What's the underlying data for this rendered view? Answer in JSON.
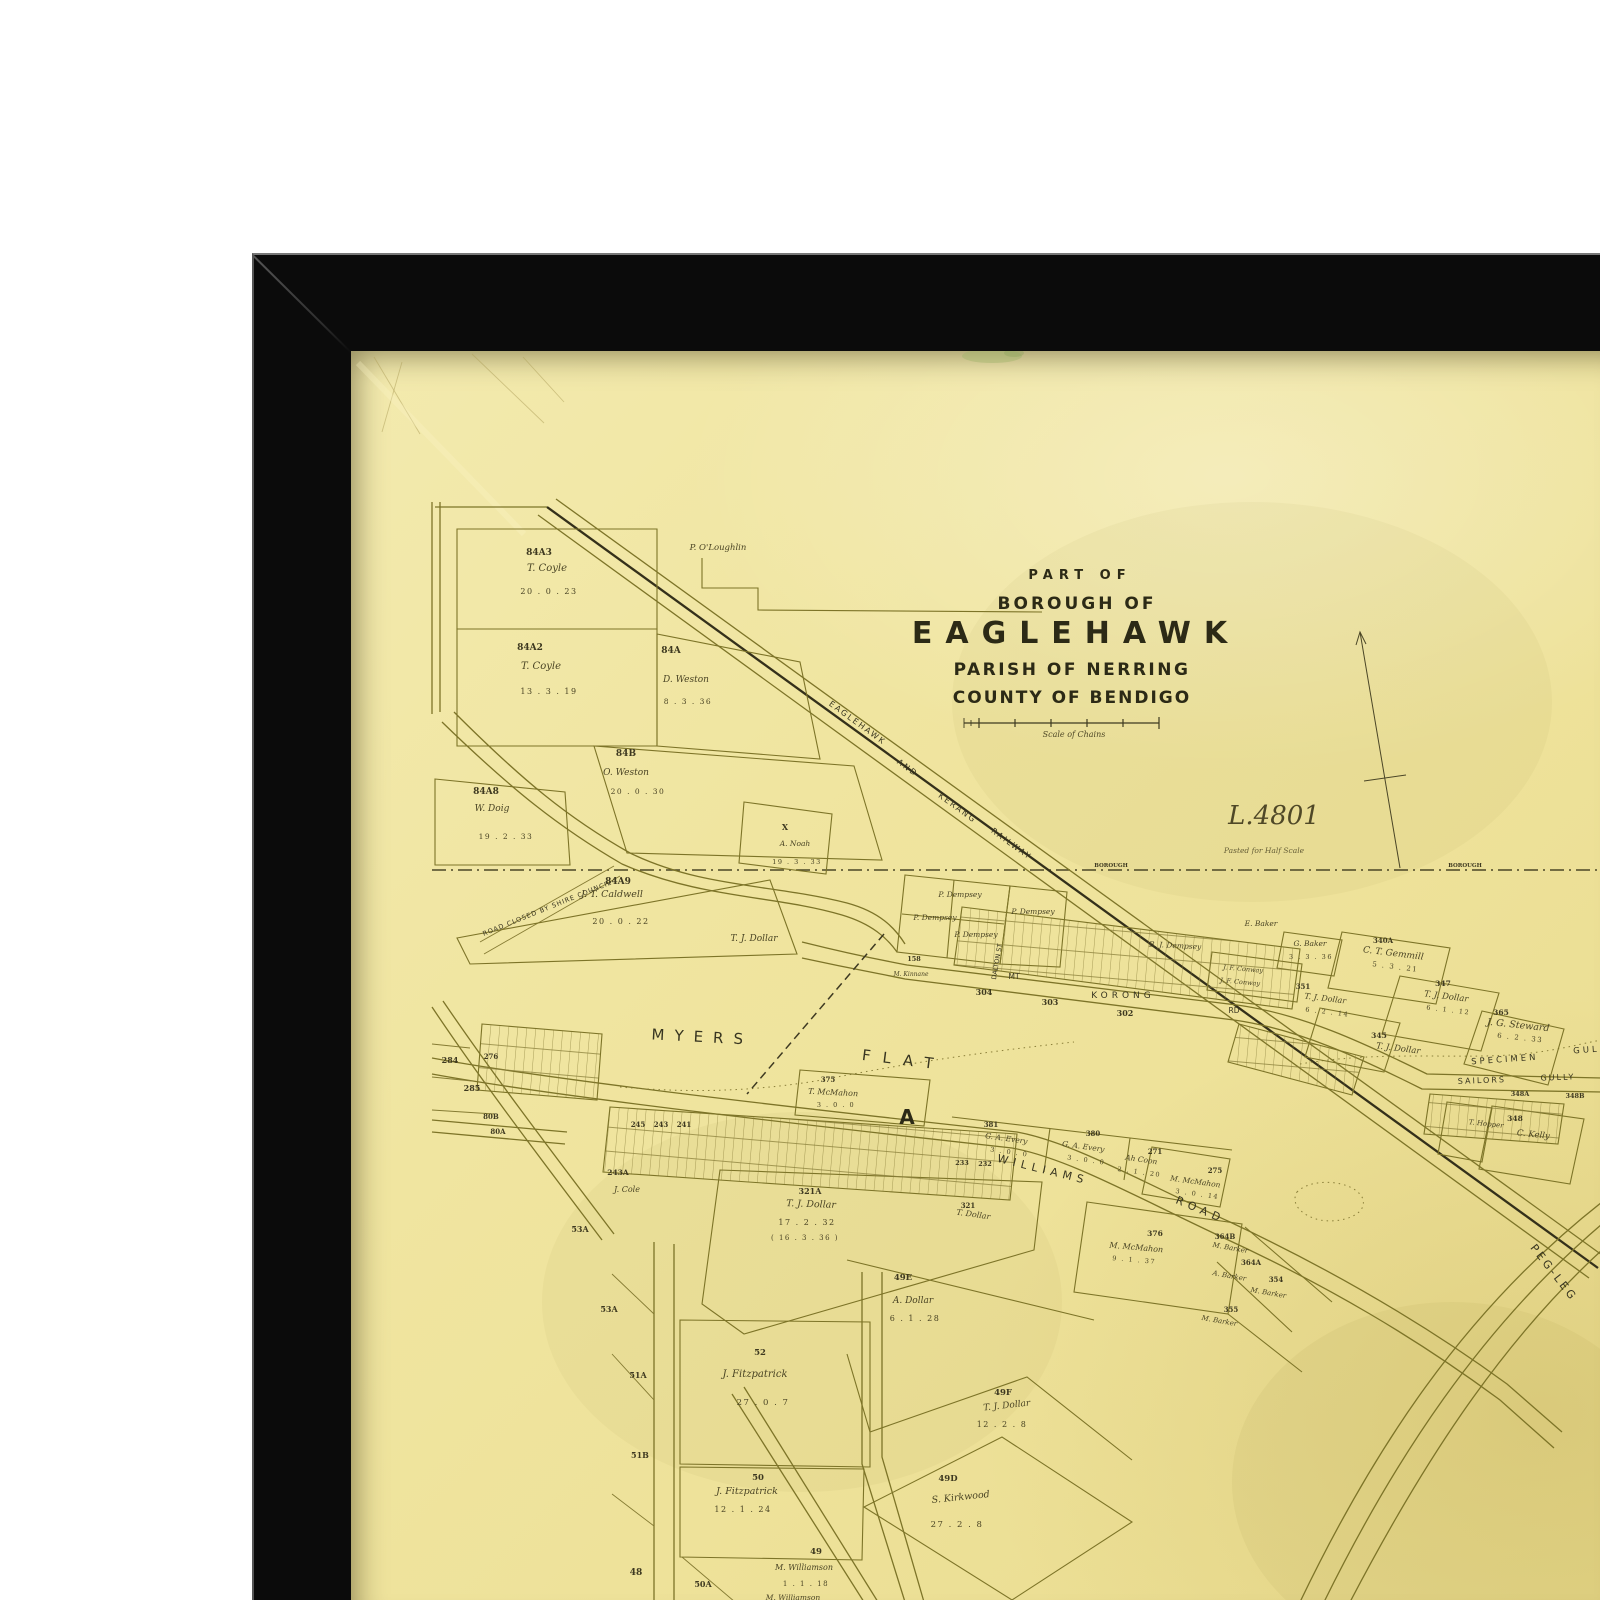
{
  "scene": {
    "background_color": "#ffffff"
  },
  "frame": {
    "color": "#0b0b0b"
  },
  "paper": {
    "color": "#efe49b",
    "line_color": "#7d7428",
    "ink_color": "#3b391f"
  },
  "map": {
    "title_block": {
      "part_of": "PART OF",
      "borough_of": "BOROUGH OF",
      "name": "EAGLEHAWK",
      "parish": "PARISH OF NERRING",
      "county": "COUNTY OF BENDIGO",
      "scale_caption": "Scale of Chains"
    },
    "annotations": {
      "plan_number": "L.4801",
      "half_scale_note": "Pasted for Half Scale",
      "boundary_label": "BOROUGH"
    },
    "railway_label": {
      "w1": "EAGLEHAWK",
      "w2": "AND",
      "w3": "KERANG",
      "w4": "RAILWAY"
    },
    "places": {
      "myers": "MYERS",
      "flat": "FLAT",
      "section_a": "A",
      "specimen": "SPECIMEN",
      "gully": "GULLY",
      "sailors": "SAILORS",
      "sailors2": "GULLY",
      "williams": "WILLIAMS",
      "road": "ROAD",
      "mt": "MT",
      "korong": "KORONG",
      "rd": "RD",
      "peg_leg": "PEG-LEG",
      "dalton_st": "DALTON ST",
      "road_closed": "ROAD CLOSED BY SHIRE COUNCIL"
    },
    "parcels": [
      {
        "owner": "T. Coyle",
        "area": "20 . 0 . 23"
      },
      {
        "owner": "T. Coyle",
        "area": "13 . 3 . 19"
      },
      {
        "owner": "D. Weston",
        "area": "8 . 3 . 36"
      },
      {
        "owner": "P. O'Loughlin"
      },
      {
        "owner": "O. Weston",
        "area": "20 . 0 . 30"
      },
      {
        "owner": "W. Doig",
        "area": "19 . 2 . 33"
      },
      {
        "owner": "J. T. Caldwell",
        "area": "20 . 0 . 22"
      },
      {
        "owner": "T. J. Dollar"
      },
      {
        "owner": "A. Noah",
        "area": "19 . 3 . 33"
      },
      {
        "owner": "P. Dempsey"
      },
      {
        "owner": "P. Dempsey"
      },
      {
        "owner": "P. Dempsey"
      },
      {
        "owner": "P. Dempsey"
      },
      {
        "owner": "B. J. Dempsey"
      },
      {
        "owner": "E. Baker"
      },
      {
        "owner": "G. Baker",
        "area": "3 . 3 . 36"
      },
      {
        "owner": "C. T. Gemmill",
        "area": "5 . 3 . 21"
      },
      {
        "owner": "J. F. Conway"
      },
      {
        "owner": "J. F. Conway"
      },
      {
        "owner": "T. J. Dollar",
        "area": "6 . 2 . 14"
      },
      {
        "owner": "T. J. Dollar"
      },
      {
        "owner": "T. J. Dollar",
        "area": "6 . 1 . 12"
      },
      {
        "owner": "J. G. Steward",
        "area": "6 . 2 . 33"
      },
      {
        "owner": "C. Kelly"
      },
      {
        "owner": "T. Hopper"
      },
      {
        "owner": "G. A. Every",
        "area": "3 . 0 . 0"
      },
      {
        "owner": "G. A. Every",
        "area": "3 . 0 . 0"
      },
      {
        "owner": "Ah Coon",
        "area": "2 . 1 . 20"
      },
      {
        "owner": "M. McMahon",
        "area": "3 . 0 . 14"
      },
      {
        "owner": "M. McMahon",
        "area": "9 . 1 . 37"
      },
      {
        "owner": "T. Dollar"
      },
      {
        "owner": "T. J. Dollar",
        "area": "17 . 2 . 32",
        "sub": "( 16 . 3 . 36 )"
      },
      {
        "owner": "T. McMahon",
        "area": "3 . 0 . 0"
      },
      {
        "owner": "M. Barker"
      },
      {
        "owner": "A. Barker"
      },
      {
        "owner": "M. Barker"
      },
      {
        "owner": "M. Barker"
      },
      {
        "owner": "J. Cole"
      },
      {
        "owner": "J. Fitzpatrick",
        "area": "27 . 0 . 7"
      },
      {
        "owner": "J. Fitzpatrick",
        "area": "12 . 1 . 24"
      },
      {
        "owner": "M. Williamson",
        "area": "1 . 1 . 18"
      },
      {
        "owner": "S. Kirkwood",
        "area": "27 . 2 . 8"
      },
      {
        "owner": "T. J. Dollar",
        "area": "12 . 2 . 8"
      },
      {
        "owner": "A. Dollar",
        "area": "6 . 1 . 28"
      },
      {
        "owner": "M. Williamson"
      },
      {
        "owner": "M. Kinnane"
      }
    ],
    "lot_numbers": [
      "284",
      "285",
      "276",
      "80B",
      "80A",
      "245",
      "243",
      "241",
      "53A",
      "53A",
      "51A",
      "51B",
      "48",
      "50A",
      "302",
      "303",
      "304",
      "X",
      "158",
      "233",
      "232",
      "348A",
      "348B",
      "340A",
      "351",
      "345",
      "347",
      "365",
      "348",
      "354",
      "355",
      "364A",
      "364B",
      "375",
      "275",
      "376",
      "380",
      "381",
      "271",
      "321",
      "321A",
      "49",
      "49D",
      "49E",
      "49F",
      "50",
      "52",
      "243A",
      "84A3",
      "84A2",
      "84A",
      "84B",
      "84A8",
      "84A9"
    ]
  }
}
